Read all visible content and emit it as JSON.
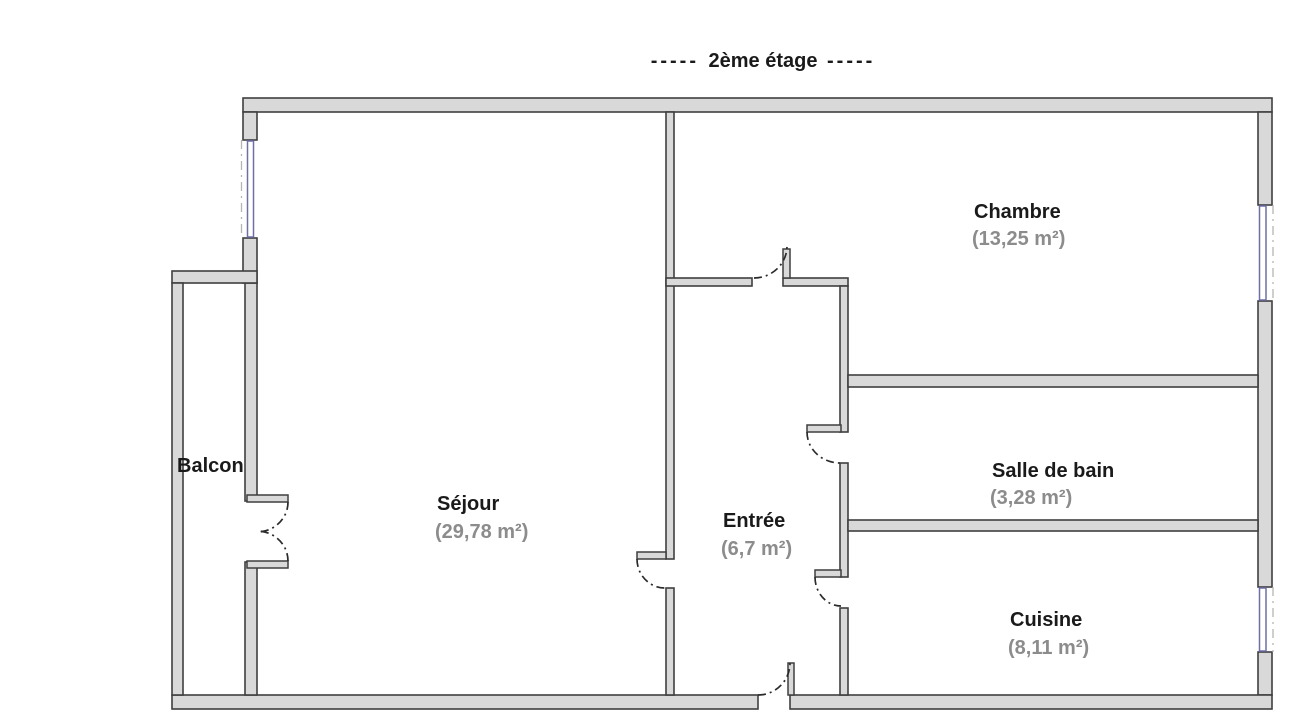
{
  "title": {
    "prefix": "-----",
    "text": "2ème étage",
    "suffix": "-----"
  },
  "rooms": {
    "sejour": {
      "name": "Séjour",
      "area": "(29,78 m²)"
    },
    "chambre": {
      "name": "Chambre",
      "area": "(13,25 m²)"
    },
    "entree": {
      "name": "Entrée",
      "area": "(6,7 m²)"
    },
    "salle_de_bain": {
      "name": "Salle de bain",
      "area": "(3,28 m²)"
    },
    "cuisine": {
      "name": "Cuisine",
      "area": "(8,11 m²)"
    },
    "balcon": {
      "name": "Balcon",
      "area": ""
    }
  },
  "colors": {
    "wall_fill": "#d9d9d9",
    "wall_outline": "#3f3f3f",
    "window_glass": "#6e6ea8",
    "window_axis": "#b5b5b5",
    "door_arc": "#2b2b2b",
    "room_name": "#1a1a1a",
    "room_area": "#8c8c8c",
    "background": "#ffffff"
  }
}
